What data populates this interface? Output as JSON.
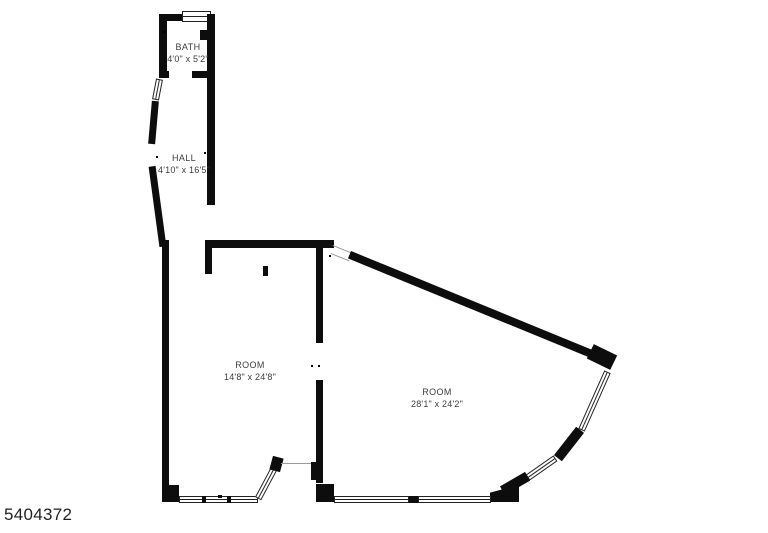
{
  "plan": {
    "id_number": "5404372",
    "wall_color": "#0d0d0d",
    "label_color": "#3d3d3d",
    "rooms": {
      "bath": {
        "name": "BATH",
        "dimensions": "4'0\" x 5'2\""
      },
      "hall": {
        "name": "HALL",
        "dimensions": "4'10\" x 16'5\""
      },
      "room1": {
        "name": "ROOM",
        "dimensions": "14'8\" x 24'8\""
      },
      "room2": {
        "name": "ROOM",
        "dimensions": "28'1\" x 24'2\""
      }
    }
  }
}
